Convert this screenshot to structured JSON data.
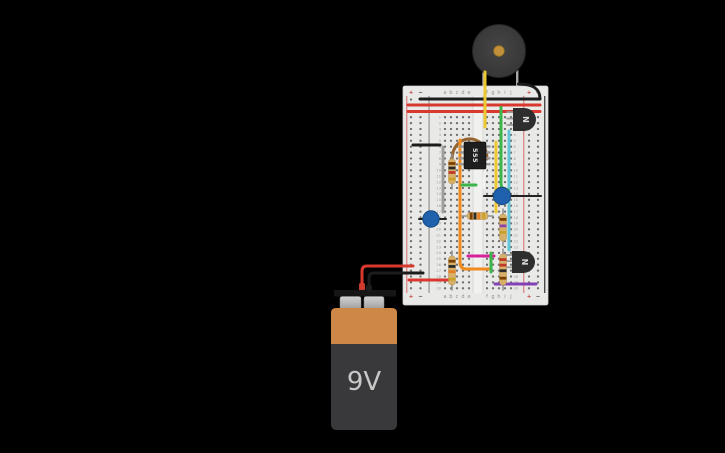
{
  "scene": {
    "width": 725,
    "height": 453,
    "background": "#000000"
  },
  "battery": {
    "label": "9V",
    "body_color": "#39393b",
    "band_color": "#cd8746",
    "cap_color": "#161616",
    "label_color": "#c8c8c8"
  },
  "buzzer": {
    "body_color": "#3a3a3a",
    "center_color": "#c0913a",
    "leg_color": "#a8a8a8"
  },
  "breadboard": {
    "rows": 30,
    "extra_rows_top": 3,
    "labels": {
      "plus": "+",
      "minus": "−",
      "columns_left": [
        "a",
        "b",
        "c",
        "d",
        "e"
      ],
      "columns_right": [
        "f",
        "g",
        "h",
        "i",
        "j"
      ]
    },
    "colors": {
      "base": "#e9e9e7",
      "edge": "#d2d2d0",
      "hole": "#6e6e6e",
      "red_line": "#db8f8f",
      "black_line": "#5a5a5a",
      "channel": "#f1f1ef",
      "channel_edge": "#d8d8d6",
      "letter": "#8f8f8f",
      "number": "#9b9b9b",
      "plus_color": "#c0392b",
      "minus_color": "#3d3d3d"
    },
    "geometry": {
      "x": 403,
      "y": 86,
      "w": 145,
      "h": 219,
      "row0_y": 99.5,
      "pitch": 5.9,
      "rail_cols": [
        411,
        420.5,
        529,
        538
      ],
      "rail_signs": [
        "+",
        "−",
        "+",
        "−"
      ],
      "cols_left": [
        445,
        451,
        457,
        463,
        469
      ],
      "cols_right": [
        487,
        493,
        499,
        505,
        511
      ],
      "num_x": [
        441,
        513.5
      ],
      "label_rows_y": [
        94,
        298
      ],
      "red_lines_x": [
        406.5,
        523.5
      ],
      "black_lines_x": [
        429,
        544.5
      ],
      "channel": {
        "x": 472.5,
        "w": 11,
        "y1": 96,
        "y2": 293
      }
    }
  },
  "ic555": {
    "label": "555",
    "x": 464,
    "y": 142,
    "w": 22,
    "h": 27,
    "pins_per_side": 4,
    "body_color": "#1e1e1e",
    "pin_color": "#999999",
    "label_color": "#e8e8e8"
  },
  "transistors": [
    {
      "name": "transistor-npn-1",
      "label": "N",
      "x": 513,
      "y": 108,
      "w": 24,
      "h": 23
    },
    {
      "name": "transistor-npn-2",
      "label": "N",
      "x": 512,
      "y": 251,
      "w": 24,
      "h": 22
    }
  ],
  "transistor_style": {
    "body_color": "#2e2e2e",
    "leg_color": "#9a9a9a",
    "label_color": "#dddddd"
  },
  "resistor_style": {
    "body_color": "#d7b06a",
    "body_stroke": "#b08d4f",
    "lead_color": "#8f8f8f"
  },
  "resistors": [
    {
      "name": "resistor-1",
      "orient": "v",
      "x": 452,
      "a": 154,
      "b": 189,
      "bands": [
        [
          "#7b3f00",
          0.18
        ],
        [
          "#2b2b2b",
          0.36
        ],
        [
          "#c0392b",
          0.54
        ],
        [
          "#c9a227",
          0.8
        ]
      ]
    },
    {
      "name": "resistor-2",
      "orient": "h",
      "y": 216,
      "a": 462,
      "b": 493,
      "bands": [
        [
          "#7b3f00",
          0.2
        ],
        [
          "#2b2b2b",
          0.38
        ],
        [
          "#e67e22",
          0.56
        ],
        [
          "#c9a227",
          0.8
        ]
      ]
    },
    {
      "name": "resistor-3",
      "orient": "v",
      "x": 503,
      "a": 209,
      "b": 246,
      "bands": [
        [
          "#7b3f00",
          0.2
        ],
        [
          "#8e44ad",
          0.44
        ],
        [
          "#c9a227",
          0.68
        ]
      ]
    },
    {
      "name": "resistor-4",
      "orient": "v",
      "x": 452,
      "a": 251,
      "b": 290,
      "bands": [
        [
          "#7b3f00",
          0.18
        ],
        [
          "#2b2b2b",
          0.36
        ],
        [
          "#e67e22",
          0.54
        ],
        [
          "#c9a227",
          0.8
        ]
      ]
    },
    {
      "name": "resistor-5",
      "orient": "v",
      "x": 503,
      "a": 249,
      "b": 290,
      "bands": [
        [
          "#c0392b",
          0.18
        ],
        [
          "#c0392b",
          0.36
        ],
        [
          "#2b2b2b",
          0.54
        ],
        [
          "#7b3f00",
          0.78
        ]
      ]
    }
  ],
  "capacitor_style": {
    "fill": "#2061ae",
    "stroke": "#16487f"
  },
  "capacitors": [
    {
      "name": "capacitor-1",
      "cx": 431,
      "cy": 219,
      "r": 8.2
    },
    {
      "name": "capacitor-2",
      "cx": 502,
      "cy": 196,
      "r": 8.6
    }
  ],
  "wires": [
    {
      "name": "wire-red-rail-top-1",
      "color": "#d8382e",
      "width": 3,
      "path": "M408,105 L540,105"
    },
    {
      "name": "wire-red-rail-top-2",
      "color": "#d8382e",
      "width": 3,
      "path": "M408,111.5 L540,111.5"
    },
    {
      "name": "wire-black-buzzer",
      "color": "#1c1c1c",
      "width": 3,
      "path": "M518.5,84 C532,84 540,88 540,99 L420,99"
    },
    {
      "name": "wire-black-jumper",
      "color": "#1c1c1c",
      "width": 3,
      "path": "M413,145 L440,145"
    },
    {
      "name": "wire-gray",
      "color": "#9e9e9e",
      "width": 3,
      "path": "M443,147 L443,212"
    },
    {
      "name": "wire-yellow-buzzer",
      "color": "#eec831",
      "width": 3,
      "path": "M485,72 L485,127"
    },
    {
      "name": "wire-yellow-2",
      "color": "#eec831",
      "width": 3,
      "path": "M496,142 L496,212"
    },
    {
      "name": "wire-cyan",
      "color": "#62c5d8",
      "width": 3,
      "path": "M509,131 L509,250"
    },
    {
      "name": "wire-green-long",
      "color": "#3cb54a",
      "width": 3,
      "path": "M501,107.5 L501,183 Q501,190 508,190"
    },
    {
      "name": "wire-white",
      "color": "#f2f2f2",
      "width": 2.4,
      "path": "M489,157 C486,167 483,176 484,188"
    },
    {
      "name": "wire-brown-arc",
      "color": "#96642f",
      "width": 3,
      "path": "M452,160 C452,132 487,132 487,159"
    },
    {
      "name": "wire-orange",
      "color": "#f08c1e",
      "width": 3,
      "path": "M460,140 L460,262 Q460,269 466,269 L490,269"
    },
    {
      "name": "wire-green-row12",
      "color": "#3cb54a",
      "width": 3,
      "path": "M462,185 L476,185"
    },
    {
      "name": "wire-magenta",
      "color": "#d6219c",
      "width": 3,
      "path": "M468,256 L494,256"
    },
    {
      "name": "wire-green-short",
      "color": "#3cb54a",
      "width": 3,
      "path": "M491,253 L491,272"
    },
    {
      "name": "wire-purple",
      "color": "#8440b5",
      "width": 3,
      "path": "M495,284 L536,284"
    },
    {
      "name": "capacitor-1-lead",
      "color": "#222222",
      "width": 2,
      "path": "M419,219 L446,219"
    },
    {
      "name": "capacitor-2-lead",
      "color": "#222222",
      "width": 2,
      "path": "M484,196 L541,196"
    },
    {
      "name": "wire-red-battery",
      "color": "#d8382e",
      "width": 3,
      "path": "M362,288 L362,271 Q362,266 367,266 L413,266"
    },
    {
      "name": "wire-black-battery",
      "color": "#1c1c1c",
      "width": 3,
      "path": "M369,291 L369,278 Q369,273 374,273 L423,273"
    },
    {
      "name": "wire-red-jumper-bot",
      "color": "#d8382e",
      "width": 3,
      "path": "M409,280 L452,280"
    }
  ]
}
